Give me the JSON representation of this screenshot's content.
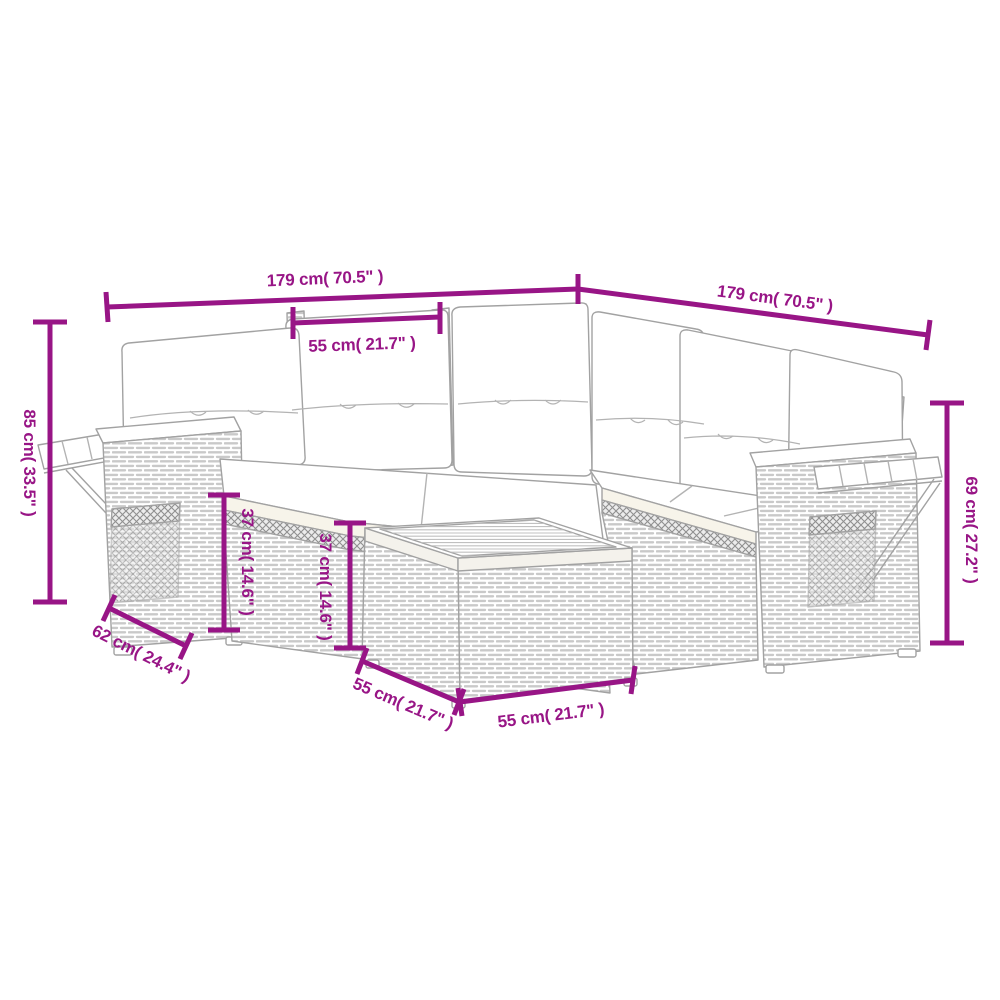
{
  "colors": {
    "dimension_accent": "#981586",
    "drawing_outline": "#a2a2a2",
    "background": "#ffffff"
  },
  "dimensions": {
    "sofa_left_length": {
      "label": "179 cm( 70.5\" )"
    },
    "sofa_right_length": {
      "label": "179 cm( 70.5\" )"
    },
    "seat_width": {
      "label": "55 cm( 21.7\" )"
    },
    "left_total_height": {
      "label": "85 cm( 33.5\" )"
    },
    "right_back_height": {
      "label": "69 cm( 27.2\" )"
    },
    "seat_height_front": {
      "label": "37 cm( 14.6\" )"
    },
    "seat_height_inner": {
      "label": "37 cm( 14.6\" )"
    },
    "armrest_depth": {
      "label": "62 cm( 24.4\" )"
    },
    "table_depth": {
      "label": "55 cm( 21.7\" )"
    },
    "table_width": {
      "label": "55 cm( 21.7\" )"
    }
  }
}
